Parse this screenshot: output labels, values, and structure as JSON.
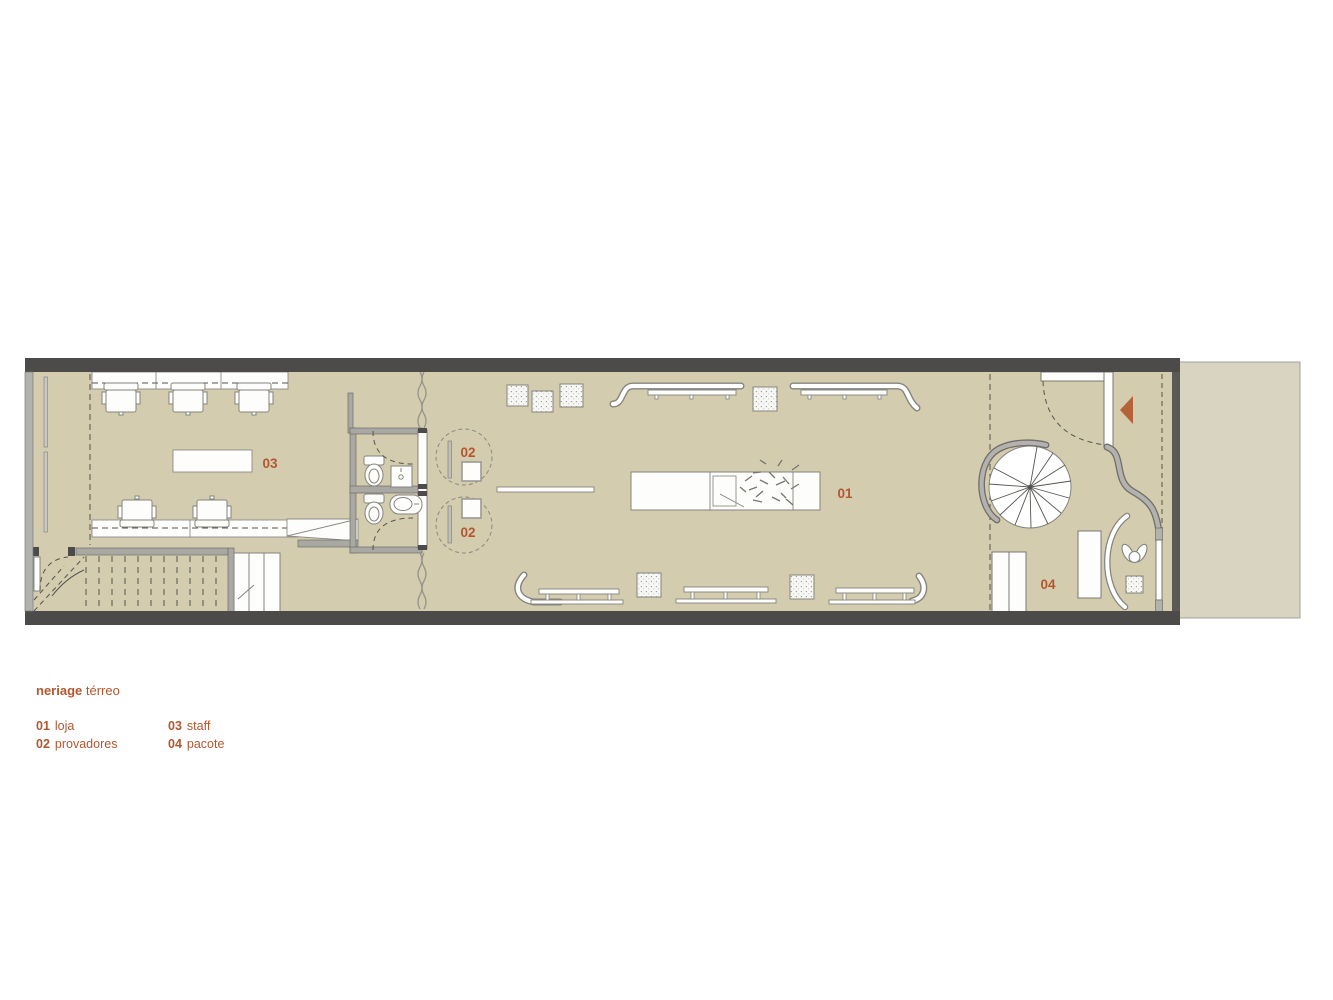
{
  "caption": {
    "brand": "neriage",
    "floor": "térreo"
  },
  "legend": {
    "items_left": [
      {
        "num": "01",
        "label": "loja"
      },
      {
        "num": "02",
        "label": "provadores"
      }
    ],
    "items_right": [
      {
        "num": "03",
        "label": "staff"
      },
      {
        "num": "04",
        "label": "pacote"
      }
    ]
  },
  "plan_labels": {
    "store": "01",
    "fitting_top": "02",
    "fitting_bottom": "02",
    "staff": "03",
    "package": "04"
  },
  "colors": {
    "accent": "#b2572f",
    "floor": "#d3ccae",
    "exterior": "#d8d4c1",
    "wall_dark": "#4c4b49",
    "wall_light": "#b2b1ad",
    "entry_arrow": "#b5623a"
  }
}
